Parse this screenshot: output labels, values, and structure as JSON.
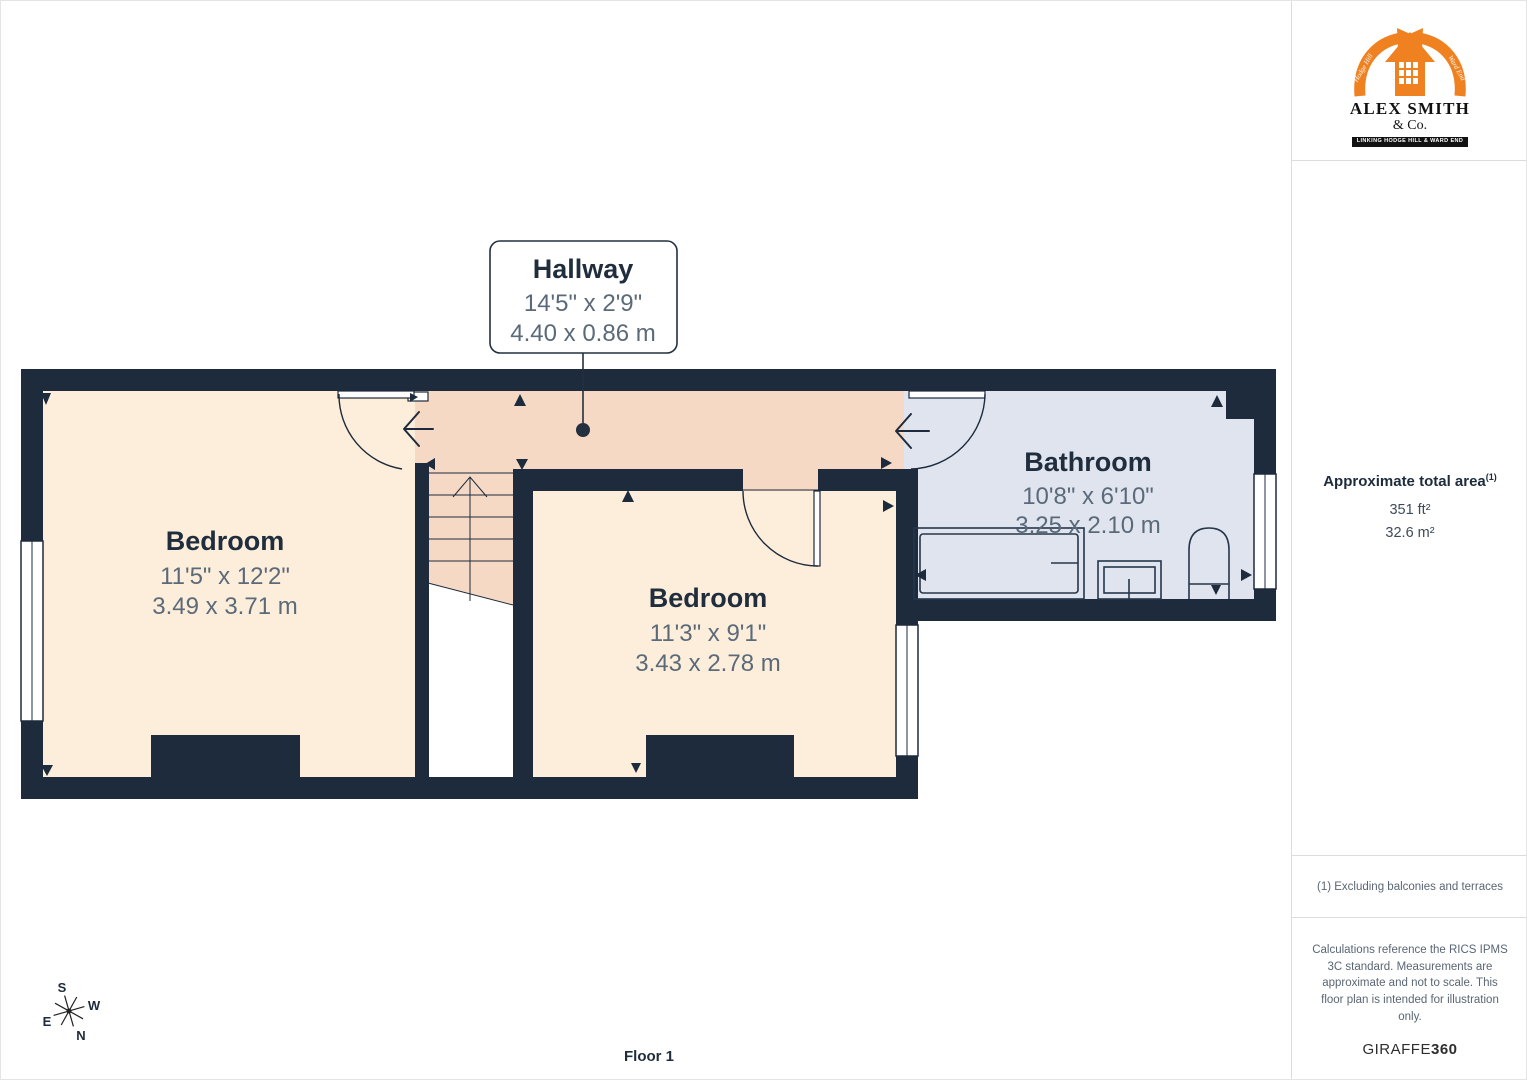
{
  "plan": {
    "floor_label": "Floor 1",
    "rooms": [
      {
        "name": "Bedroom",
        "dims_imperial": "11'5\" x 12'2\"",
        "dims_metric": "3.49 x 3.71 m"
      },
      {
        "name": "Bedroom",
        "dims_imperial": "11'3\" x 9'1\"",
        "dims_metric": "3.43 x 2.78 m"
      },
      {
        "name": "Bathroom",
        "dims_imperial": "10'8\" x 6'10\"",
        "dims_metric": "3.25 x 2.10 m"
      },
      {
        "name": "Hallway",
        "dims_imperial": "14'5\" x 2'9\"",
        "dims_metric": "4.40 x 0.86 m"
      }
    ],
    "compass": {
      "north": "N",
      "south": "S",
      "east": "E",
      "west": "W"
    },
    "colors": {
      "wall": "#1d2b3c",
      "bedroom_fill": "#fdeedc",
      "hallway_fill": "#f5d9c5",
      "bathroom_fill": "#dfe4ef"
    }
  },
  "sidebar": {
    "logo": {
      "name_line1": "ALEX SMITH",
      "name_line2": "& Co.",
      "banner": "LINKING HODGE HILL & WARD END",
      "ribbon_left": "Hodge Hill",
      "ribbon_right": "Ward End",
      "accent_color": "#f08120"
    },
    "area": {
      "title": "Approximate total area",
      "footnote_marker": "(1)",
      "imperial": "351 ft²",
      "metric": "32.6 m²"
    },
    "footnote": "(1) Excluding balconies and terraces",
    "disclaimer": "Calculations reference the RICS IPMS 3C standard. Measurements are approximate and not to scale. This floor plan is intended for illustration only.",
    "brand": {
      "name": "GIRAFFE",
      "suffix": "360"
    }
  }
}
